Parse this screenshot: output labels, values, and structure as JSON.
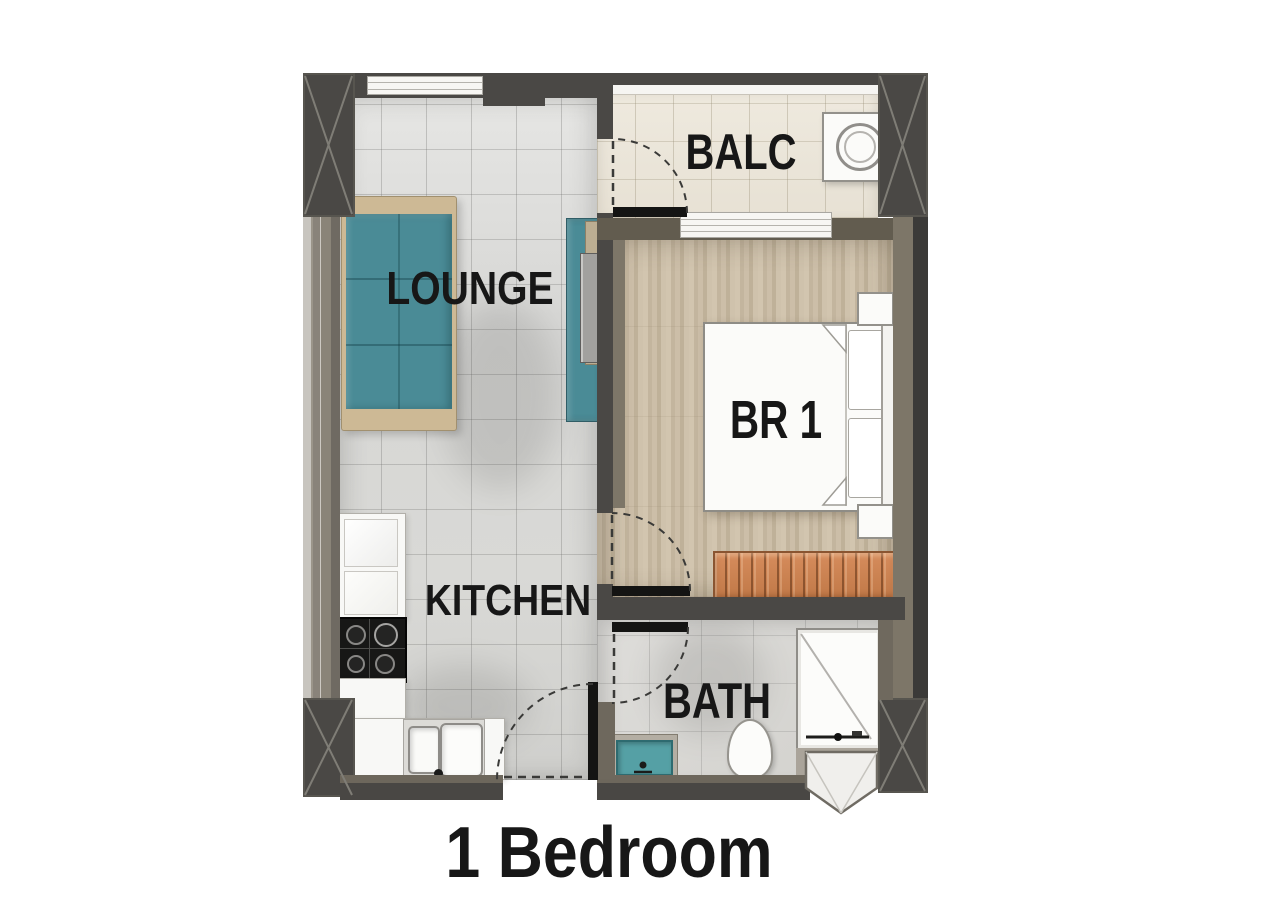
{
  "title": {
    "label": "1 Bedroom"
  },
  "rooms": {
    "lounge": {
      "label": "LOUNGE"
    },
    "balcony": {
      "label": "BALC"
    },
    "bedroom": {
      "label": "BR 1"
    },
    "kitchen": {
      "label": "KITCHEN"
    },
    "bath": {
      "label": "BATH"
    }
  },
  "colors": {
    "wall-dark": "#4a4845",
    "wall-outer": "#3b3a38",
    "wall-taupe": "#625c4f",
    "wall-taupe-light": "#7d7668",
    "wall-side": "#8a8477",
    "sofa-teal": "#4a8b96",
    "vanity-teal": "#55a0a5",
    "wardrobe-orange": "#cb8252",
    "fixture-white": "#fbfbf9",
    "fixture-border": "#93918b",
    "line-black": "#141413",
    "text": "#171717"
  }
}
